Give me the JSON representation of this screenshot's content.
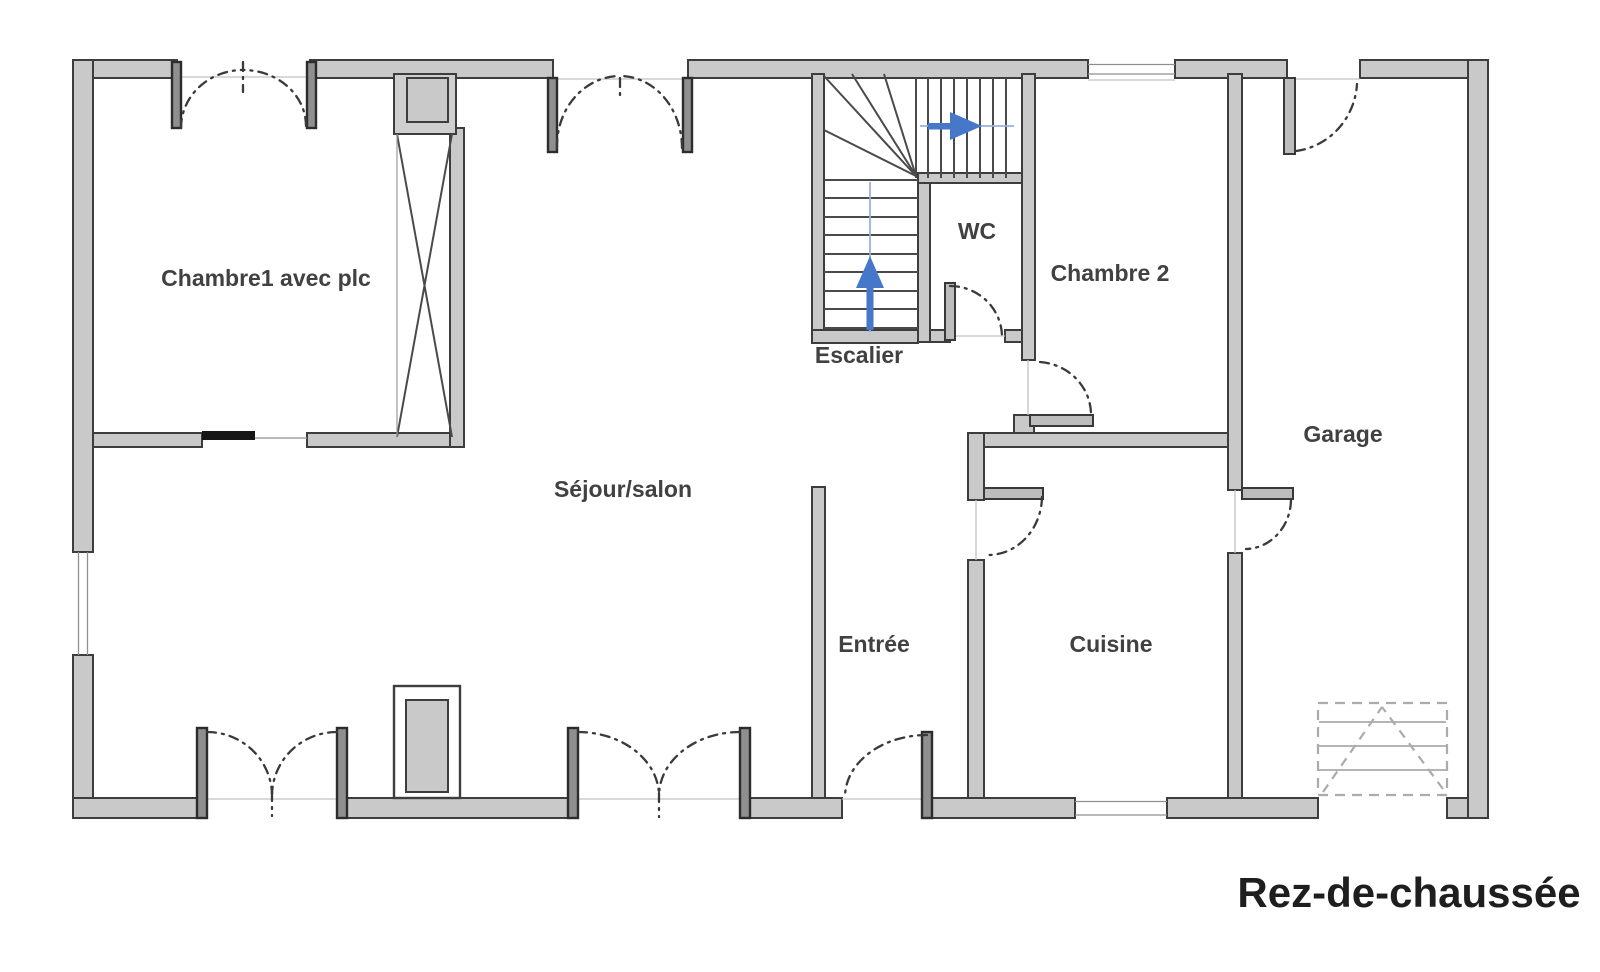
{
  "title": {
    "text": "Rez-de-chaussée"
  },
  "rooms": {
    "chambre1": "Chambre1 avec plc",
    "sejour": "Séjour/salon",
    "escalier": "Escalier",
    "wc": "WC",
    "chambre2": "Chambre 2",
    "garage": "Garage",
    "entree": "Entrée",
    "cuisine": "Cuisine"
  },
  "colors": {
    "wall_fill": "#c9c9c9",
    "wall_outline": "#3d3d3d",
    "stair_lines": "#4a4a4a",
    "arrow_blue": "#4677c8",
    "walk_line_blue": "#98b1dd",
    "label_text": "#414141",
    "title_text": "#1e1e1e",
    "background": "#ffffff"
  },
  "features": {
    "windows": [
      {
        "id": "chambre1-window",
        "wall": "top",
        "type": "double-casement"
      },
      {
        "id": "sejour-window",
        "wall": "top",
        "type": "double-casement"
      },
      {
        "id": "chambre2-window",
        "wall": "top",
        "type": "fixed"
      },
      {
        "id": "sejour-side-window",
        "wall": "left",
        "type": "fixed"
      },
      {
        "id": "cuisine-window",
        "wall": "bottom",
        "type": "fixed"
      }
    ],
    "doors": [
      {
        "id": "sejour-french-door-west",
        "wall": "bottom",
        "type": "double-leaf"
      },
      {
        "id": "sejour-french-door-east",
        "wall": "bottom",
        "type": "double-leaf"
      },
      {
        "id": "entree-door",
        "wall": "bottom",
        "type": "single-swing"
      },
      {
        "id": "chambre1-sliding-door",
        "wall": "interior",
        "type": "sliding"
      },
      {
        "id": "wc-door",
        "wall": "interior",
        "type": "single-swing"
      },
      {
        "id": "chambre2-door",
        "wall": "interior",
        "type": "single-swing"
      },
      {
        "id": "cuisine-door",
        "wall": "interior",
        "type": "single-swing"
      },
      {
        "id": "cuisine-to-garage-door",
        "wall": "interior",
        "type": "single-swing"
      },
      {
        "id": "garage-side-door",
        "wall": "top",
        "type": "single-swing"
      },
      {
        "id": "garage-vehicle-door",
        "wall": "bottom",
        "type": "garage-door-with-dashed-apron"
      }
    ],
    "stairs": {
      "label_ref": "escalier",
      "flights": [
        "straight-up-flight",
        "winders",
        "top-landing-flight"
      ],
      "direction_arrows": 2
    },
    "closet": {
      "room": "chambre1",
      "symbol": "x-brace-column"
    },
    "fireplace_block": {
      "room": "sejour",
      "position": "bottom-wall"
    }
  }
}
